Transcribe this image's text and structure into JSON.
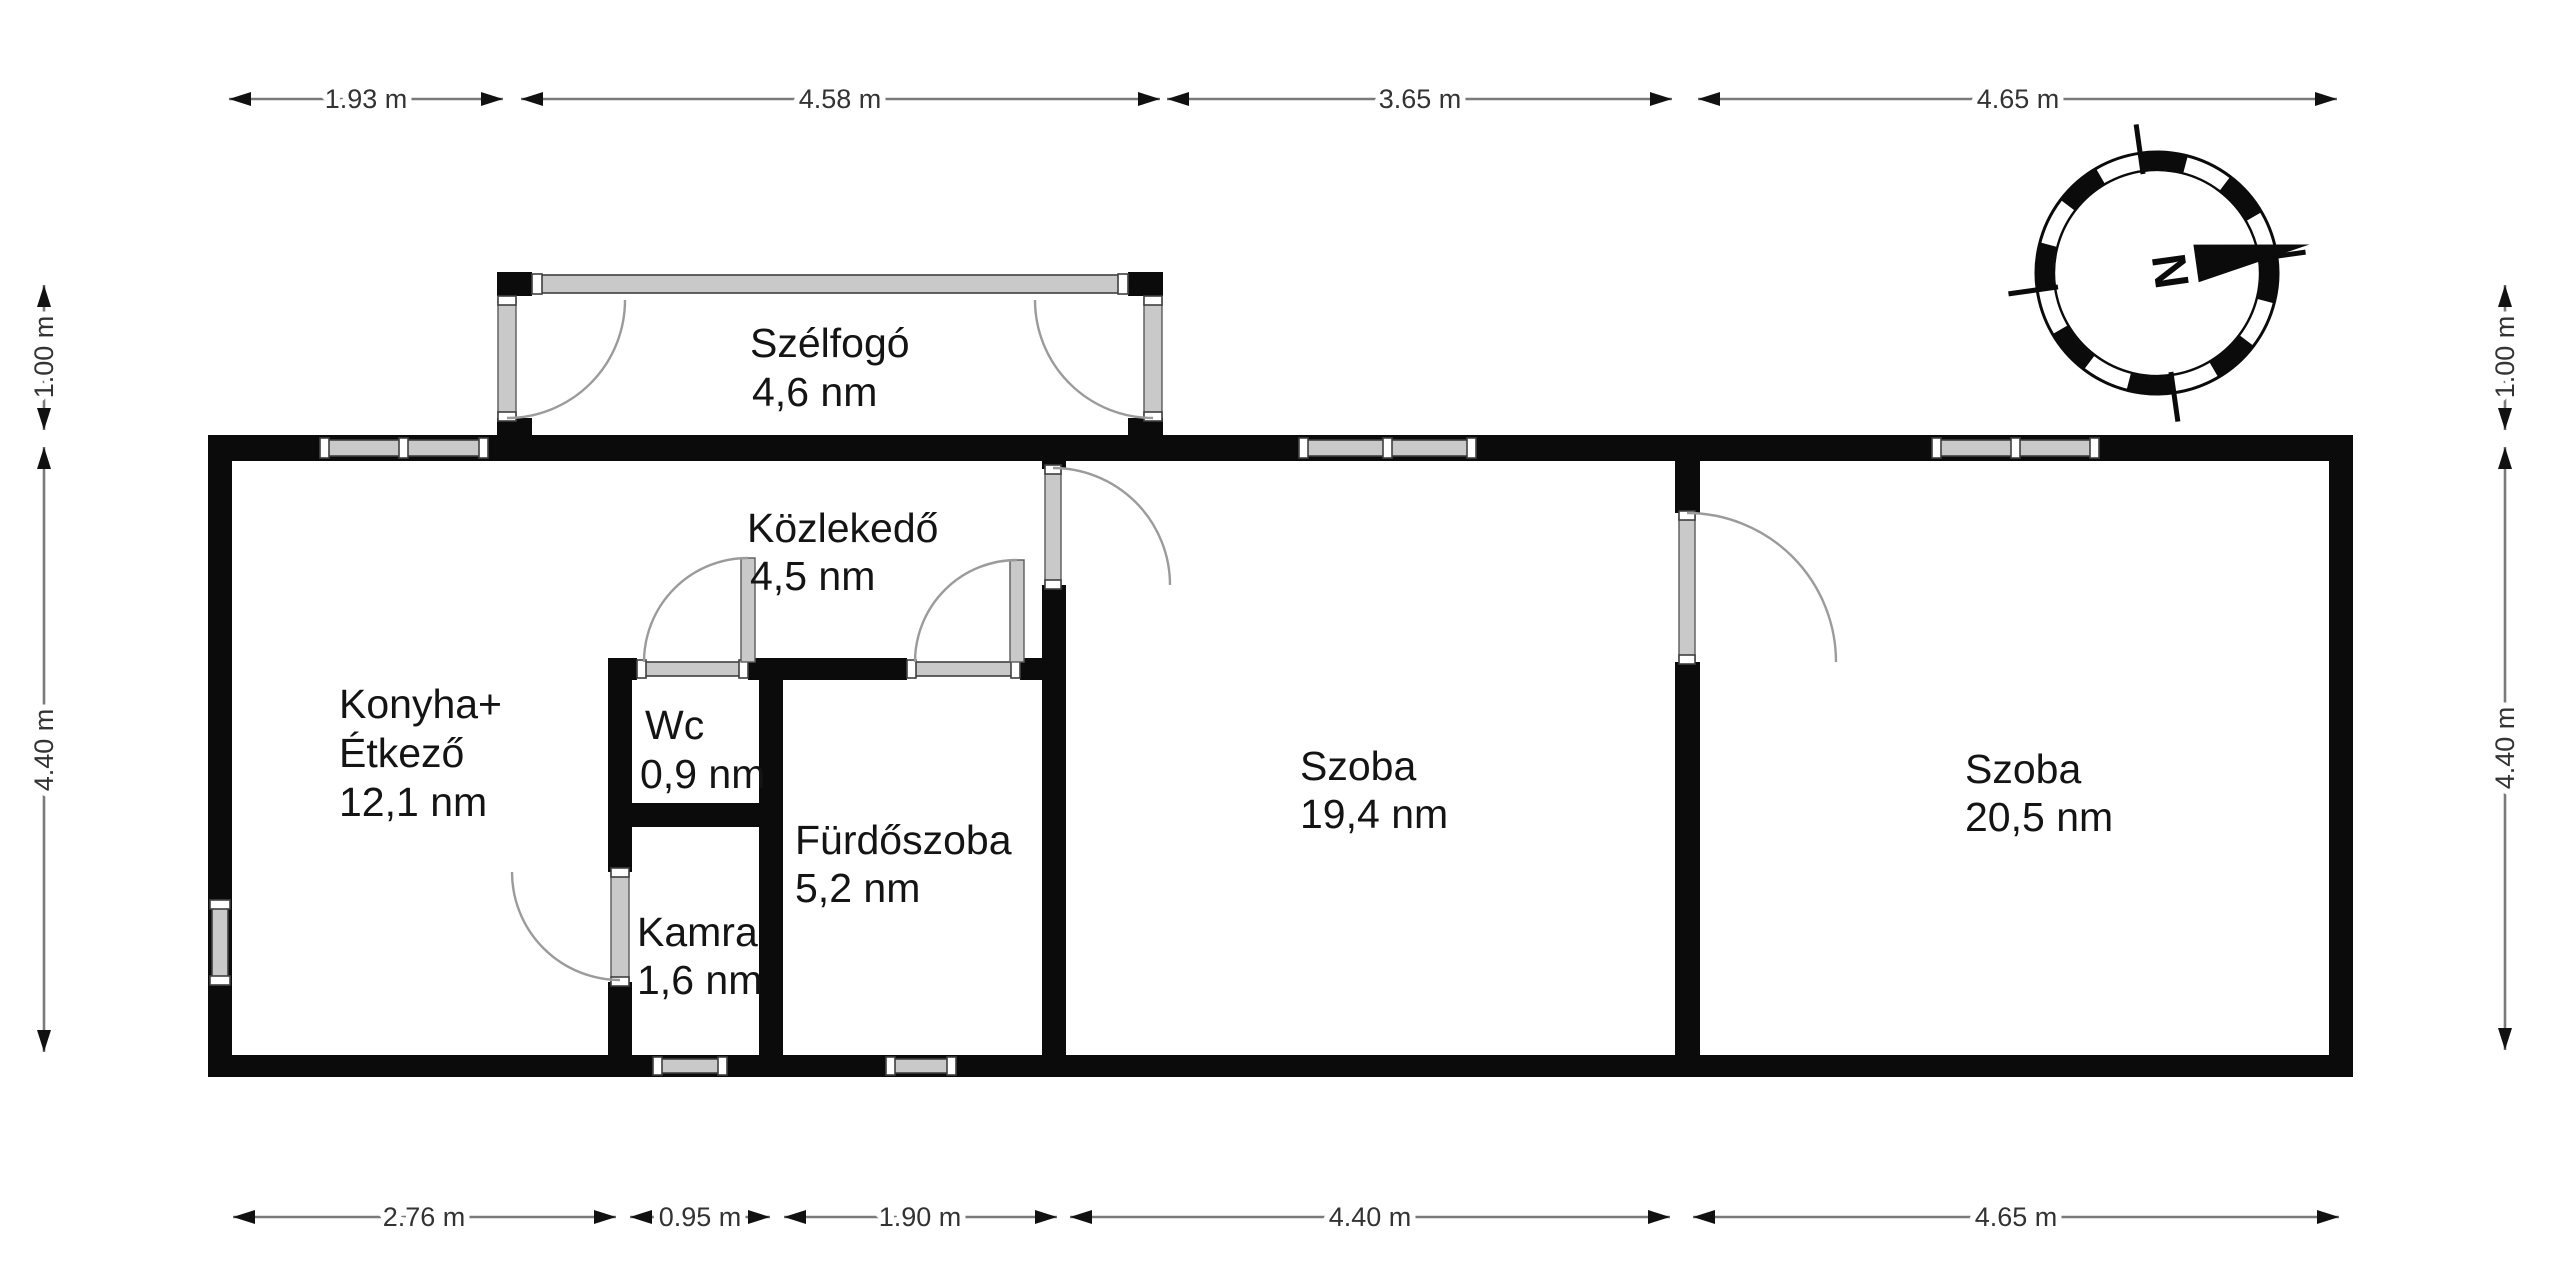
{
  "title": "Floor plan",
  "rooms": [
    {
      "id": "szelfogo",
      "name": "Szélfogó",
      "area": "4,6 nm"
    },
    {
      "id": "kozlekedo",
      "name": "Közlekedő",
      "area": "4,5 nm"
    },
    {
      "id": "konyha",
      "name": "Konyha+",
      "name2": "Étkező",
      "area": "12,1 nm"
    },
    {
      "id": "wc",
      "name": "Wc",
      "area": "0,9 nm"
    },
    {
      "id": "furdoszoba",
      "name": "Fürdőszoba",
      "area": "5,2 nm"
    },
    {
      "id": "kamra",
      "name": "Kamra",
      "area": "1,6 nm"
    },
    {
      "id": "szoba1",
      "name": "Szoba",
      "area": "19,4 nm"
    },
    {
      "id": "szoba2",
      "name": "Szoba",
      "area": "20,5 nm"
    }
  ],
  "dimensions": {
    "top": [
      {
        "label": "1.93 m"
      },
      {
        "label": "4.58 m"
      },
      {
        "label": "3.65 m"
      },
      {
        "label": "4.65 m"
      }
    ],
    "bottom": [
      {
        "label": "2.76 m"
      },
      {
        "label": "0.95 m"
      },
      {
        "label": "1.90 m"
      },
      {
        "label": "4.40 m"
      },
      {
        "label": "4.65 m"
      }
    ],
    "left": [
      {
        "label": "1.00 m"
      },
      {
        "label": "4.40 m"
      }
    ],
    "right": [
      {
        "label": "1.00 m"
      },
      {
        "label": "4.40 m"
      }
    ]
  },
  "compass": {
    "label": "N"
  },
  "colors": {
    "wall": "#0b0b0b",
    "window_fill": "#c9c9c9",
    "door_arc": "#9b9b9b",
    "dimension_line": "#7a7a7a",
    "text": "#141414",
    "background": "#ffffff"
  }
}
